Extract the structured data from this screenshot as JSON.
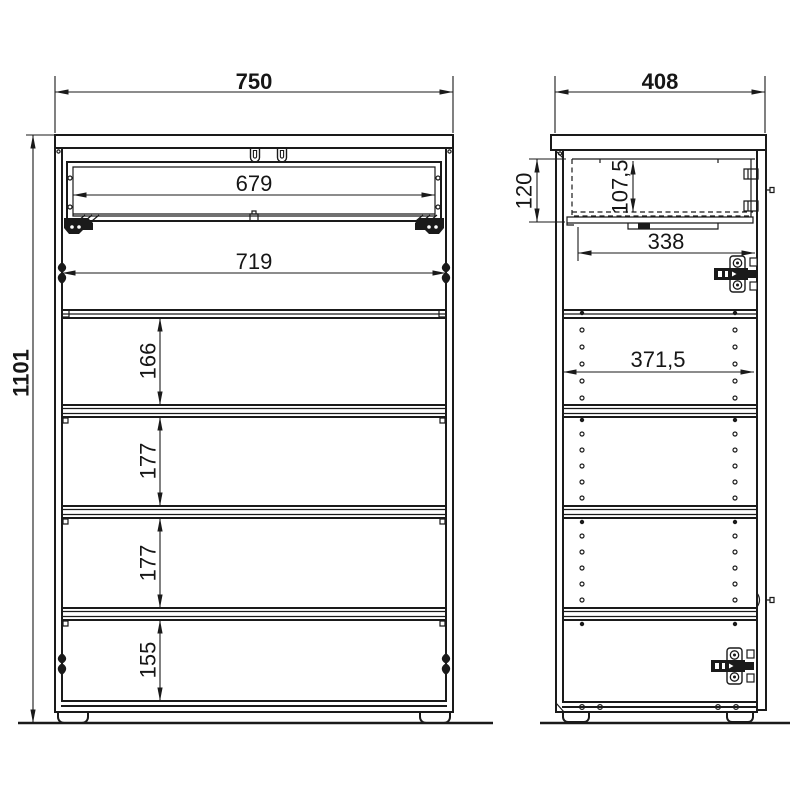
{
  "drawing": {
    "background_color": "#ffffff",
    "line_color": "#1a1a1a",
    "views": {
      "front": {
        "overall_width_mm": "750",
        "overall_height_mm": "1101",
        "drawer_inner_width_mm": "679",
        "interior_width_mm": "719",
        "shelf_spacing_mm": [
          "166",
          "177",
          "177",
          "155"
        ]
      },
      "side": {
        "overall_depth_mm": "408",
        "drawer_front_height_mm": "120",
        "drawer_side_height_mm": "107,5",
        "drawer_depth_mm": "338",
        "interior_depth_mm": "371,5"
      }
    }
  }
}
